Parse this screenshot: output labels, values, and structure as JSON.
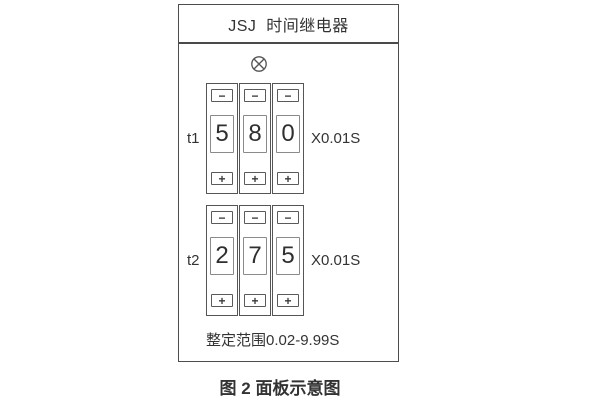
{
  "figure": {
    "panel": {
      "title": "JSJ  时间继电器",
      "lamp_icon": "indicator-lamp",
      "rows": [
        {
          "label": "t1",
          "digits": [
            "5",
            "8",
            "0"
          ],
          "multiplier": "X0.01S"
        },
        {
          "label": "t2",
          "digits": [
            "2",
            "7",
            "5"
          ],
          "multiplier": "X0.01S"
        }
      ],
      "decrement_label": "−",
      "increment_label": "+",
      "range_text": "整定范围0.02-9.99S"
    },
    "caption": "图 2 面板示意图"
  },
  "colors": {
    "line": "#4d4d4d",
    "window_border": "#8a8a8a",
    "text": "#333333",
    "background": "#ffffff"
  }
}
